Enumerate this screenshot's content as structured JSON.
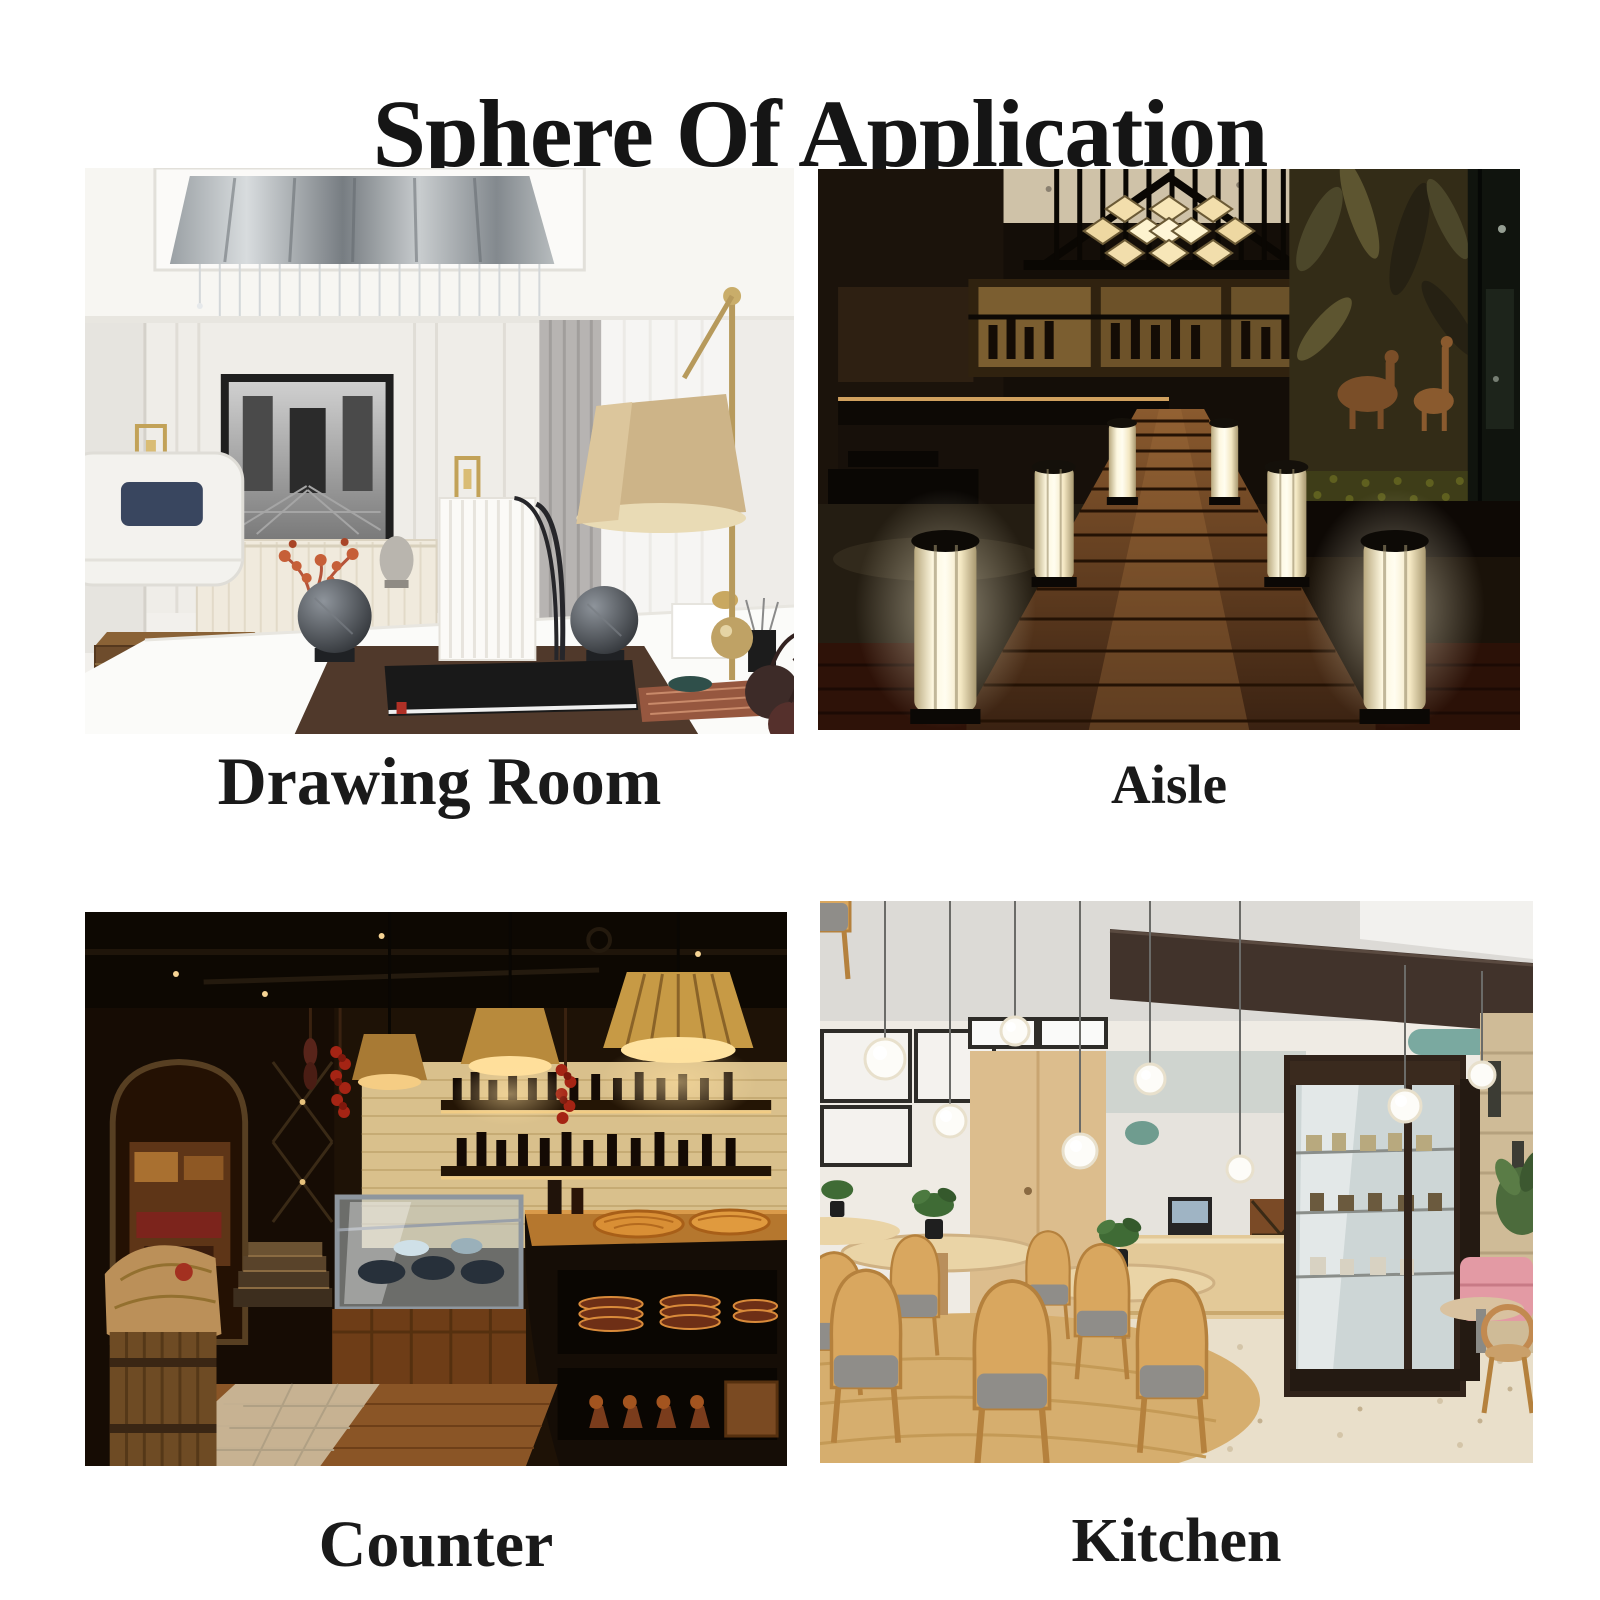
{
  "title": "Sphere Of Application",
  "applications": [
    {
      "label": "Drawing Room",
      "photo": "bright luxury living room with recessed crystal ceiling chandelier, black-framed artwork, gold wall sconces, brass table lamp and white desk with books"
    },
    {
      "label": "Aisle",
      "photo": "dark restaurant walkway of wooden planks lined with glowing pillar lamps, warm-lit bar on the left, jungle mural and moss wall on the right, honeycomb light under a gable"
    },
    {
      "label": "Counter",
      "photo": "warm rustic cafe counter with pleated pendant lamps, backlit bottle shelves, hanging chili strings, glass display case, pies on a wooden counter and an arched doorway with stairs"
    },
    {
      "label": "Kitchen",
      "photo": "bright modern cafe with globe pendant lights on thin rods, light wood door and chairs, service counter and a dark-framed glass display cabinet on a terrazzo floor"
    }
  ],
  "colors": {
    "background": "#ffffff",
    "title": "#151515",
    "caption": "#1a1a1a"
  }
}
